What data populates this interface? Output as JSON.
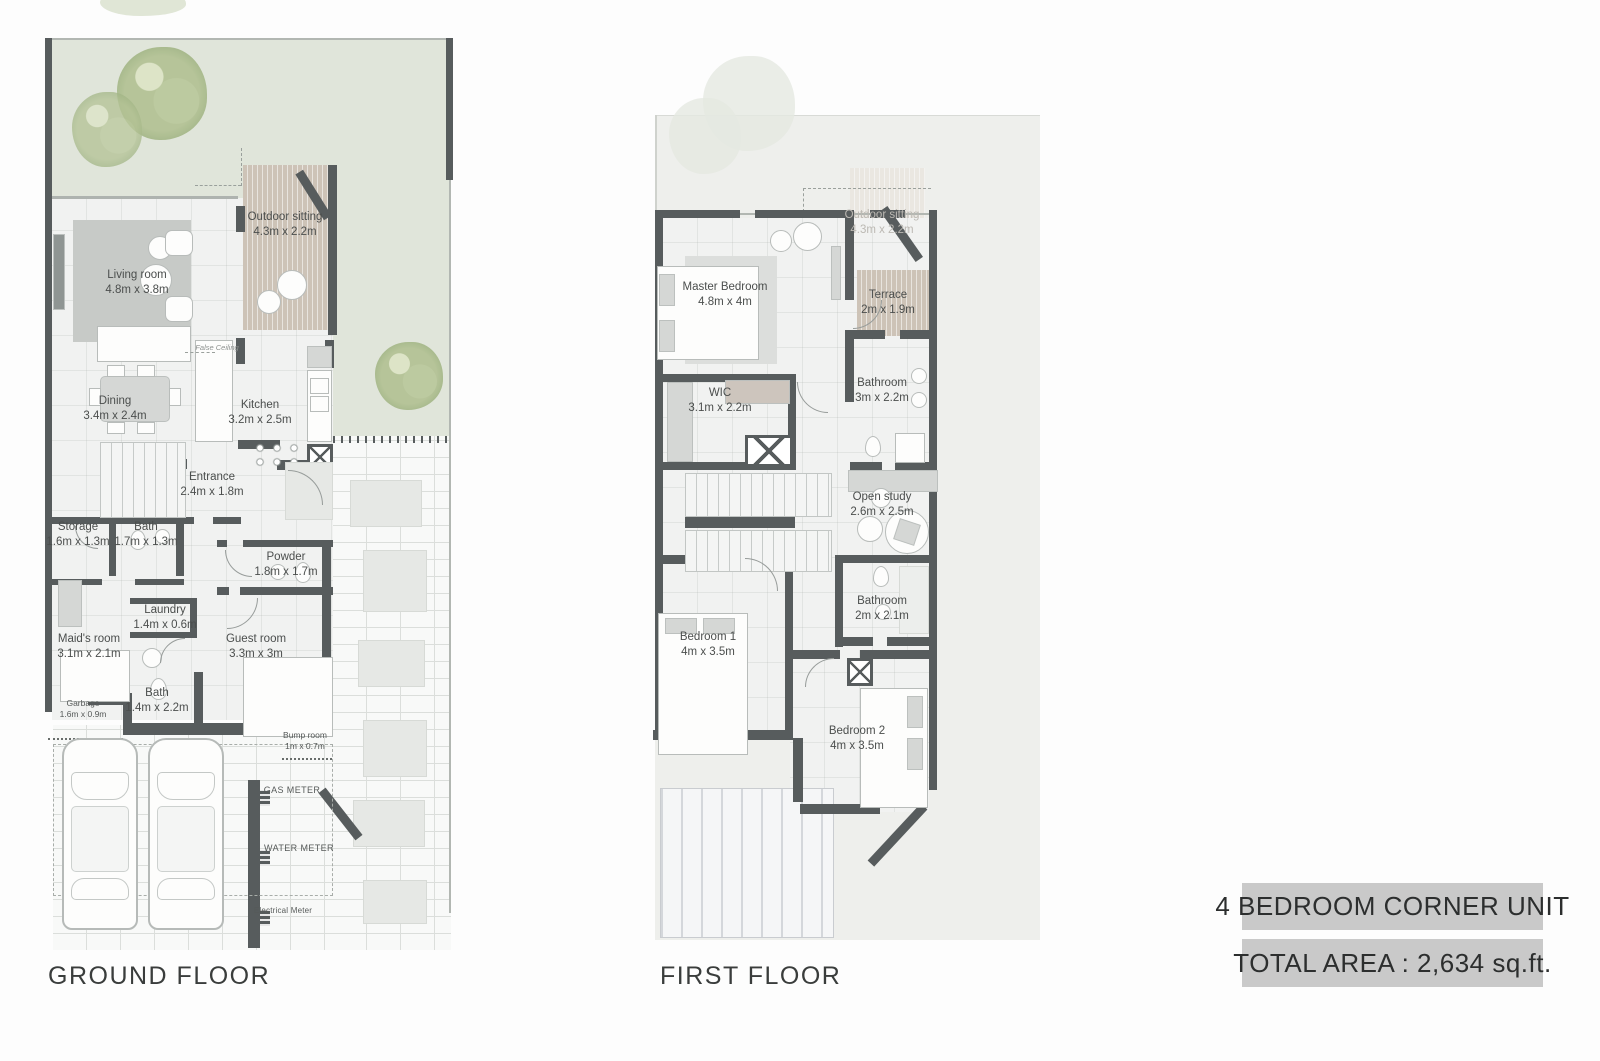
{
  "title_block": {
    "unit_type": "4 BEDROOM CORNER UNIT",
    "total_area": "TOTAL AREA : 2,634 sq.ft."
  },
  "ground_floor": {
    "title": "GROUND FLOOR",
    "rooms": [
      {
        "name": "Outdoor sitting",
        "dims": "4.3m x 2.2m"
      },
      {
        "name": "Living room",
        "dims": "4.8m x 3.8m"
      },
      {
        "name": "Dining",
        "dims": "3.4m x 2.4m"
      },
      {
        "name": "Kitchen",
        "dims": "3.2m x 2.5m"
      },
      {
        "name": "Entrance",
        "dims": "2.4m x 1.8m"
      },
      {
        "name": "Storage",
        "dims": "1.6m x 1.3m"
      },
      {
        "name": "Bath",
        "dims": "1.7m x 1.3m"
      },
      {
        "name": "Powder",
        "dims": "1.8m x 1.7m"
      },
      {
        "name": "Laundry",
        "dims": "1.4m x 0.6m"
      },
      {
        "name": "Maid's room",
        "dims": "3.1m x 2.1m"
      },
      {
        "name": "Guest room",
        "dims": "3.3m x 3m"
      },
      {
        "name": "Bath",
        "dims": "1.4m x 2.2m"
      },
      {
        "name": "Garbage",
        "dims": "1.6m x 0.9m"
      },
      {
        "name": "Bump room",
        "dims": "1m x 0.7m"
      }
    ],
    "meters": [
      "GAS METER",
      "WATER METER",
      "Electrical Meter"
    ],
    "annotations": {
      "false_ceiling": "False Ceiling"
    }
  },
  "first_floor": {
    "title": "FIRST FLOOR",
    "rooms": [
      {
        "name": "Outdoor sitting",
        "dims": "4.3m x 2.2m"
      },
      {
        "name": "Master Bedroom",
        "dims": "4.8m x 4m"
      },
      {
        "name": "Terrace",
        "dims": "2m x 1.9m"
      },
      {
        "name": "WIC",
        "dims": "3.1m x 2.2m"
      },
      {
        "name": "Bathroom",
        "dims": "3m x 2.2m"
      },
      {
        "name": "Open study",
        "dims": "2.6m x 2.5m"
      },
      {
        "name": "Bathroom",
        "dims": "2m x 2.1m"
      },
      {
        "name": "Bedroom 1",
        "dims": "4m x 3.5m"
      },
      {
        "name": "Bedroom 2",
        "dims": "4m x 3.5m"
      }
    ]
  },
  "colors": {
    "wall": "#575c5d",
    "garden": "#e0e5da",
    "deck": "#cdc3b7",
    "title_bar_bg": "#c9c9c9"
  }
}
